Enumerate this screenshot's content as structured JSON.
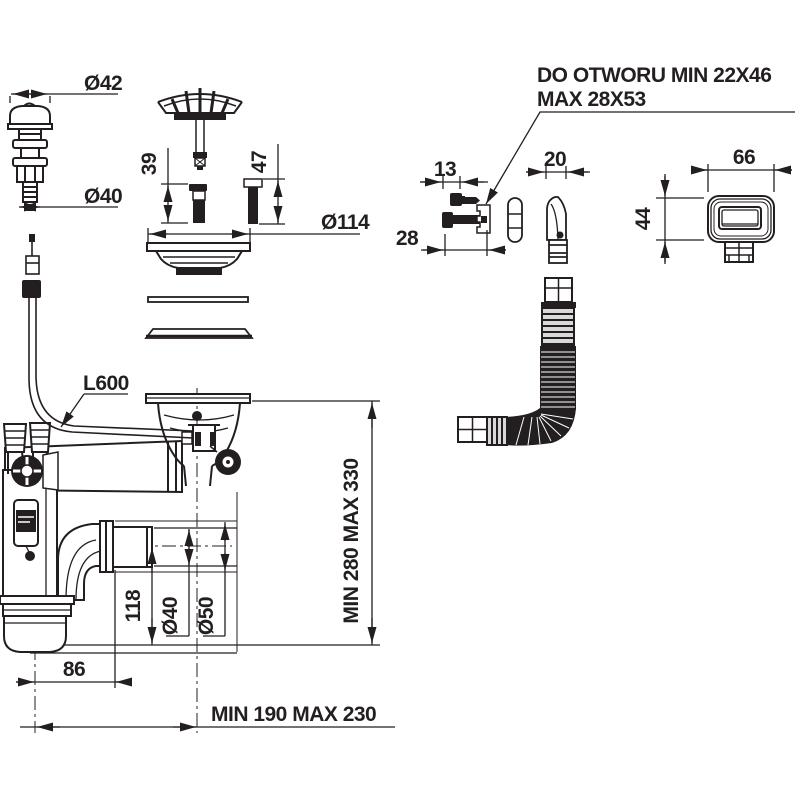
{
  "note": {
    "line1": "DO OTWORU MIN 22X46",
    "line2": "MAX 28X53"
  },
  "dimensions": {
    "plug_top_diameter": "Ø42",
    "plug_bottom_diameter": "Ø40",
    "pin_short_length": "39",
    "pin_long_length": "47",
    "flange_diameter": "Ø114",
    "screw_head_span": "13",
    "screw_length": "28",
    "spout_width": "20",
    "cover_width": "66",
    "cover_height": "44",
    "cable_length": "L600",
    "cup_depth": "118",
    "outlet_pipe_diameter": "Ø40",
    "outlet_nut_diameter": "Ø50",
    "cup_offset": "86",
    "height_range": "MIN 280 MAX 330",
    "width_range": "MIN 190 MAX 230"
  },
  "colors": {
    "line": "#231f20",
    "hose_fill": "#d9d9d9",
    "background": "#ffffff"
  }
}
